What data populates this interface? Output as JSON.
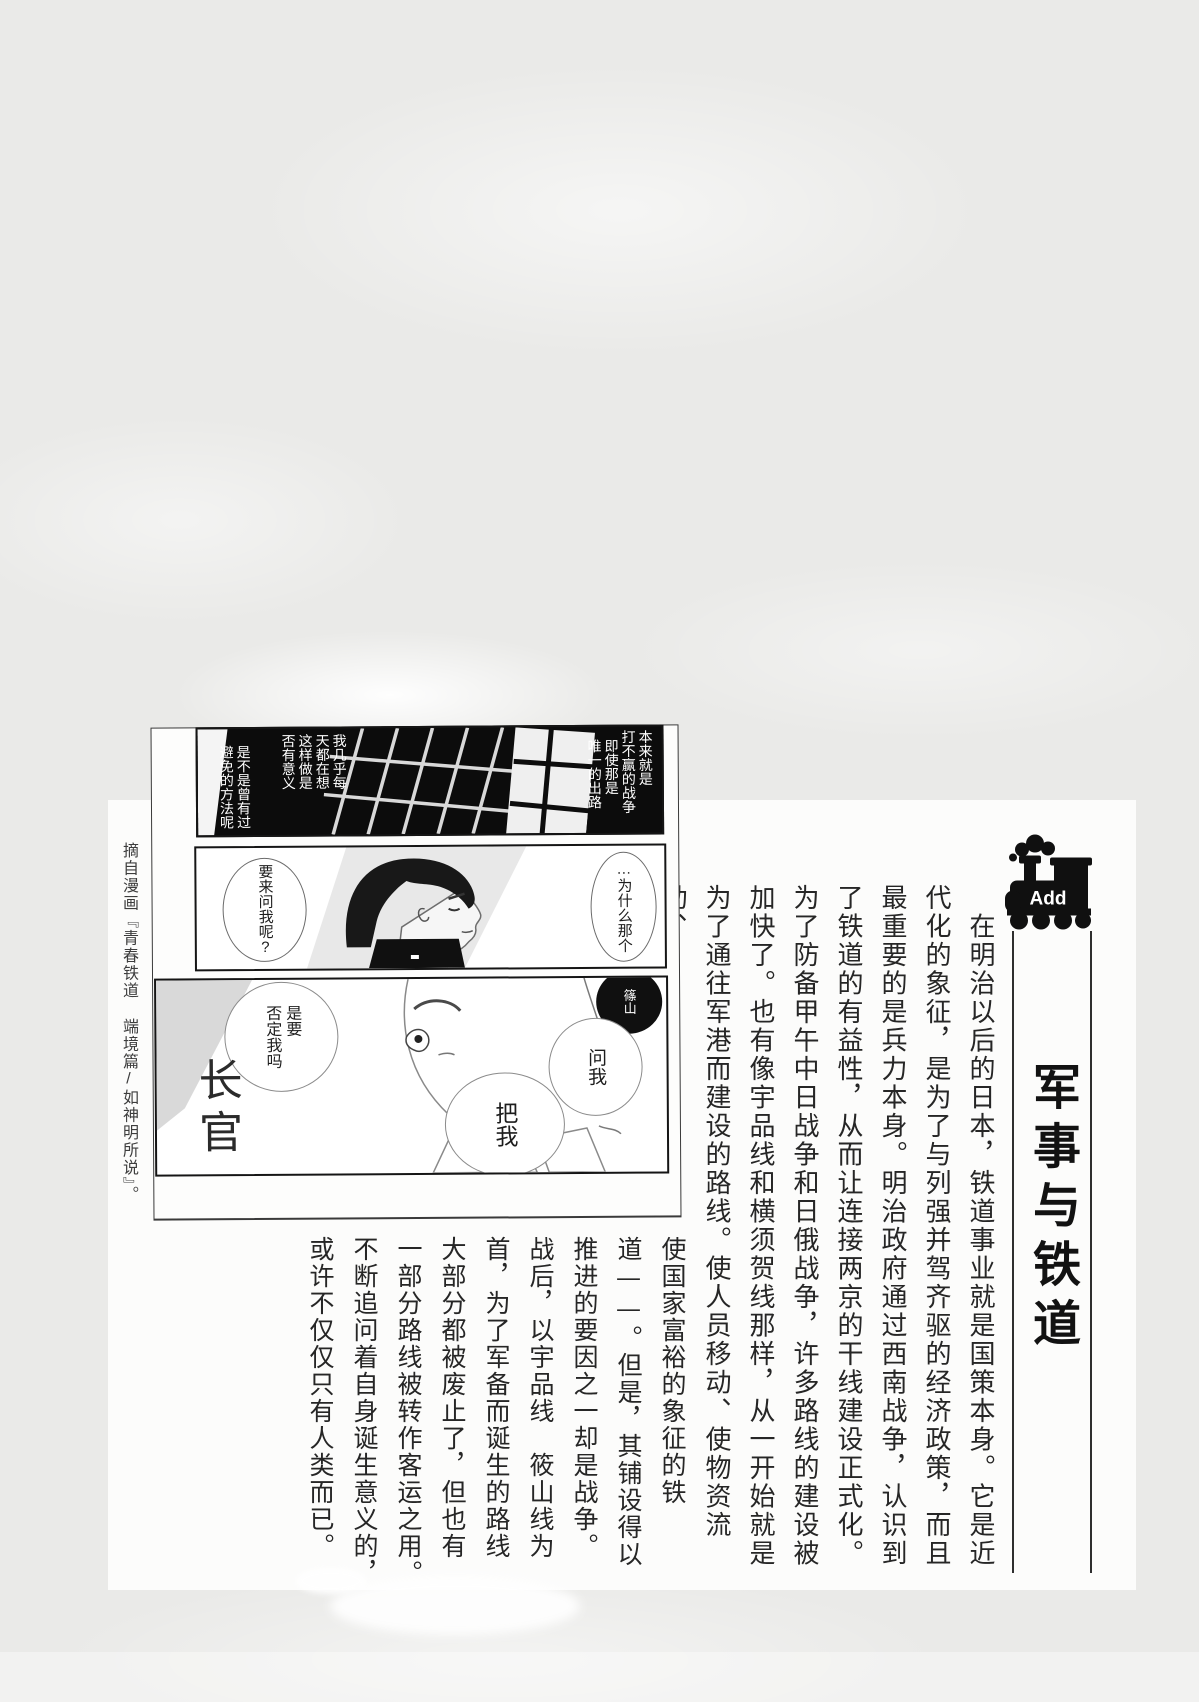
{
  "colors": {
    "page_bg": "#eaeae8",
    "sheet_bg": "#fcfcfb",
    "ink": "#262626",
    "title_ink": "#121212",
    "badge_bg": "#101010"
  },
  "badge": {
    "label": "Add",
    "icon": "train-icon"
  },
  "title": {
    "text": "军事与铁道"
  },
  "article": {
    "main_columns": [
      "　在明治以后的日本，铁道事业就是国策本身。它是近",
      "代化的象征，是为了与列强并驾齐驱的经济政策，而且",
      "最重要的是兵力本身。明治政府通过西南战争，认识到",
      "了铁道的有益性，从而让连接两京的干线建设正式化。",
      "为了防备甲午中日战争和日俄战争，许多路线的建设被",
      "加快了。也有像宇品线和横须贺线那样，从一开始就是",
      "为了通往军港而建设的路线。使人员移动、使物资流动、"
    ],
    "lower_columns": [
      "使国家富裕的象征的铁",
      "道——。但是，其铺设得以",
      "推进的要因之一却是战争。",
      "战后，以宇品线　筱山线为",
      "首，为了军备而诞生的路线",
      "大部分都被废止了，但也有",
      "一部分路线被转作客运之用。",
      "不断追问着自身诞生意义的，",
      "或许不仅仅只有人类而已。"
    ]
  },
  "manga": {
    "panel1": {
      "bubble_right_1": "本来就是\n打不赢的战争",
      "bubble_right_2": "即使那是\n唯一的出路",
      "bubble_left_1": "我几乎每\n天都在想\n这样做是\n否有意义",
      "bubble_left_2": "是不是曾有过\n避免的方法呢"
    },
    "panel2": {
      "bubble_left": "要来问我呢?",
      "bubble_right": "…为什么那个"
    },
    "panel3": {
      "bubble_big": "是要\n否定我吗",
      "name_tag": "篠山",
      "bubble_1": "问我",
      "bubble_2": "把我",
      "shout": "长官"
    }
  },
  "caption": {
    "text": "摘自漫画『青春铁道 端境篇/如神明所说』。"
  }
}
